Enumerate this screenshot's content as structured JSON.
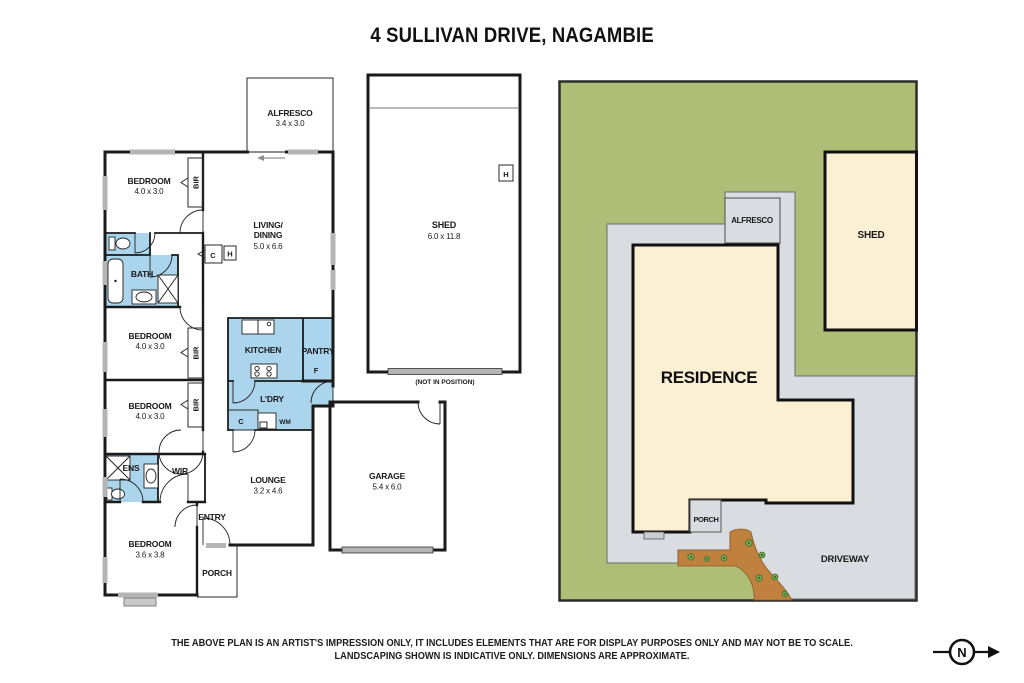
{
  "title": "4 SULLIVAN DRIVE, NAGAMBIE",
  "floorplan": {
    "alfresco": {
      "label": "ALFRESCO",
      "dims": "3.4 x 3.0"
    },
    "bedroom1": {
      "label": "BEDROOM",
      "dims": "4.0 x 3.0"
    },
    "bedroom2": {
      "label": "BEDROOM",
      "dims": "4.0 x 3.0"
    },
    "bedroom3": {
      "label": "BEDROOM",
      "dims": "4.0 x 3.0"
    },
    "bedroom4": {
      "label": "BEDROOM",
      "dims": "3.6 x 3.8"
    },
    "living": {
      "line1": "LIVING/",
      "line2": "DINING",
      "dims": "5.0 x 6.6"
    },
    "lounge": {
      "label": "LOUNGE",
      "dims": "3.2 x 4.6"
    },
    "garage": {
      "label": "GARAGE",
      "dims": "5.4 x 6.0"
    },
    "kitchen": {
      "label": "KITCHEN"
    },
    "pantry": {
      "label": "PANTRY",
      "fridge": "F"
    },
    "laundry": {
      "label": "L'DRY",
      "cupboard": "C",
      "washing_machine": "WM"
    },
    "bath": {
      "label": "BATH"
    },
    "ens": {
      "label": "ENS"
    },
    "wir": {
      "label": "WIR"
    },
    "entry": {
      "label": "ENTRY"
    },
    "porch": {
      "label": "PORCH"
    },
    "bir_label": "BIR",
    "hall_cupboard": "C",
    "hot_water": "H"
  },
  "shed": {
    "label": "SHED",
    "dims": "6.0 x 11.8",
    "hot_water": "H",
    "note": "(NOT IN POSITION)"
  },
  "siteplan": {
    "residence": "RESIDENCE",
    "shed": "SHED",
    "alfresco": "ALFRESCO",
    "porch": "PORCH",
    "driveway": "DRIVEWAY"
  },
  "disclaimer": {
    "line1": "THE ABOVE PLAN IS AN ARTIST'S IMPRESSION ONLY, IT INCLUDES ELEMENTS THAT ARE FOR DISPLAY PURPOSES ONLY AND MAY NOT BE TO SCALE.",
    "line2": "LANDSCAPING SHOWN IS INDICATIVE ONLY. DIMENSIONS ARE APPROXIMATE."
  },
  "compass": {
    "label": "N"
  },
  "colors": {
    "wall": "#1a1a1a",
    "wet_area_blue": "#aad5ec",
    "window_gray": "#b5b5b5",
    "lawn_green": "#aebe77",
    "hardscape_gray": "#d9dde1",
    "building_cream": "#fcf0d4",
    "garden_bed_brown": "#c0813f",
    "plant_green": "#6b9f4e"
  }
}
